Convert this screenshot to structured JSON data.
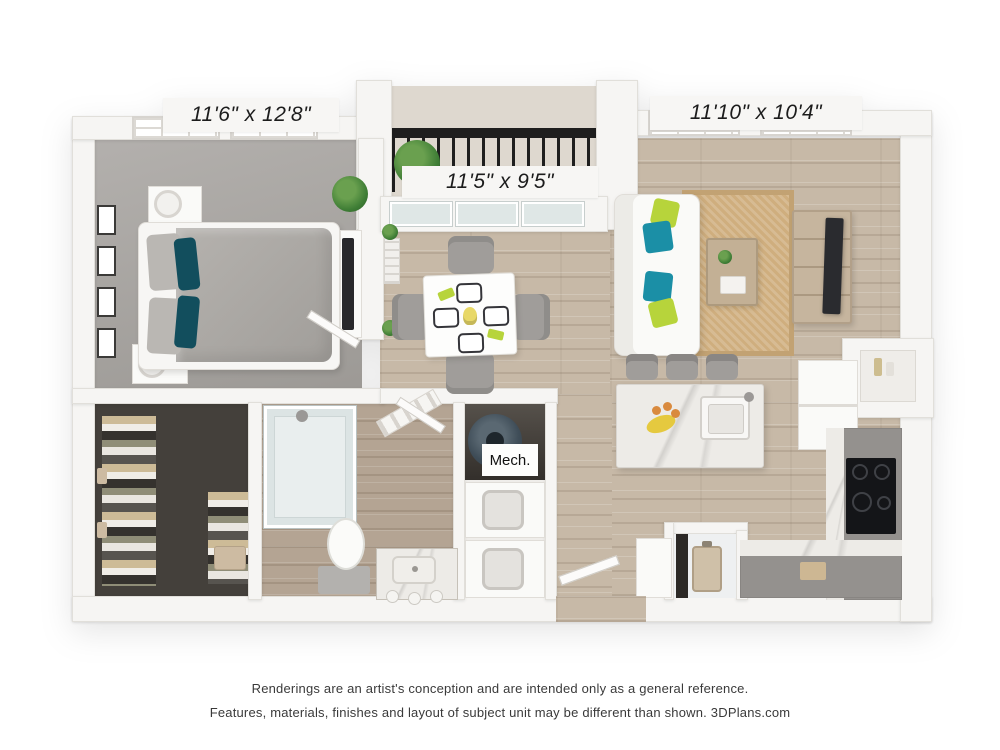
{
  "plan": {
    "labels": {
      "bedroom": "11'6\" x 12'8\"",
      "dining": "11'5\" x 9'5\"",
      "living": "11'10\" x 10'4\"",
      "mech": "Mech."
    },
    "colors": {
      "wall": "#f6f5f3",
      "wood_floor": "#c7b9a7",
      "bath_tile": "#b4a493",
      "bedroom_carpet": "#a7a4a1",
      "closet_floor": "#44403b",
      "teal_pillow": "#1b8fa6",
      "dark_teal_pillow": "#124e5d",
      "lime_pillow": "#b7d43b",
      "jute_rug": "#cfae7e",
      "cabinet_grey": "#94918e",
      "marble": "#edebe7",
      "cooktop_black": "#141518",
      "water_heater": "#3f4d58",
      "railing_black": "#1e1e1e",
      "furniture_wood": "#c3b095"
    }
  },
  "footer": {
    "line1": "Renderings are an artist's conception and are intended only as a general reference.",
    "line2": "Features, materials, finishes and layout of subject unit may be different than shown. 3DPlans.com"
  }
}
